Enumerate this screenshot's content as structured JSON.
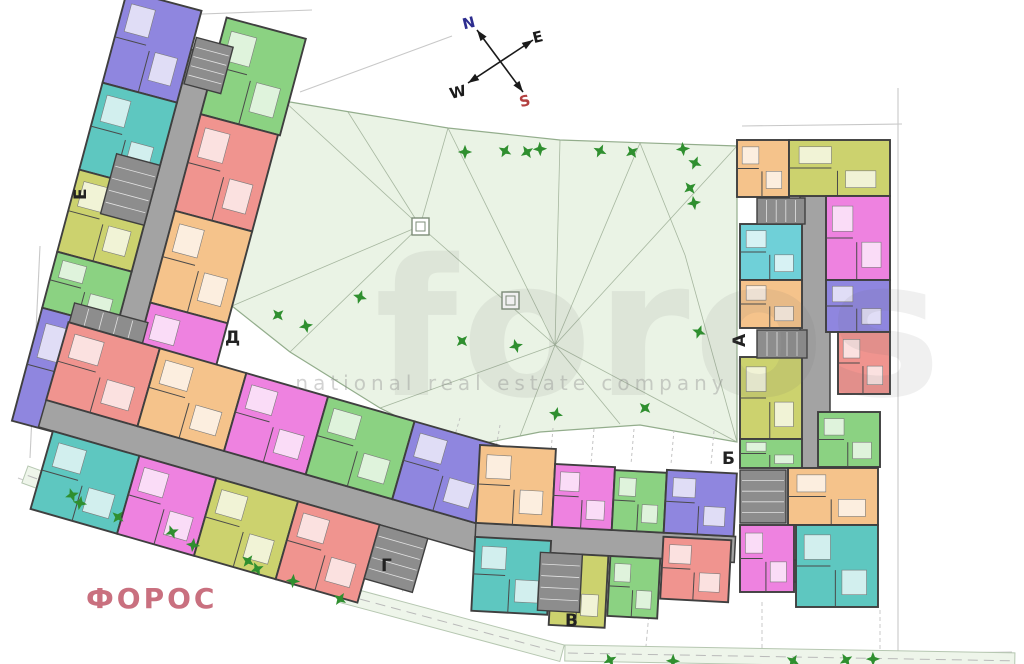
{
  "logo": {
    "text": "ФОРОС"
  },
  "watermark": {
    "line1": "foros",
    "line2": "national real estate company"
  },
  "compass": {
    "axes": [
      {
        "x1": 477,
        "y1": 30,
        "x2": 523,
        "y2": 92
      },
      {
        "x1": 468,
        "y1": 83,
        "x2": 533,
        "y2": 40
      }
    ],
    "letters": [
      {
        "t": "N",
        "x": 470,
        "y": 28,
        "c": "#2d2d8f"
      },
      {
        "t": "E",
        "x": 539,
        "y": 42,
        "c": "#1a1a1a"
      },
      {
        "t": "W",
        "x": 459,
        "y": 97,
        "c": "#1a1a1a"
      },
      {
        "t": "S",
        "x": 526,
        "y": 106,
        "c": "#b34040"
      }
    ]
  },
  "section_labels": [
    {
      "t": "Е",
      "x": 86,
      "y": 200,
      "r": -90
    },
    {
      "t": "Д",
      "x": 225,
      "y": 343,
      "r": 0
    },
    {
      "t": "Г",
      "x": 381,
      "y": 571,
      "r": 0
    },
    {
      "t": "В",
      "x": 565,
      "y": 626,
      "r": 0
    },
    {
      "t": "Б",
      "x": 722,
      "y": 464,
      "r": 0
    },
    {
      "t": "А",
      "x": 745,
      "y": 347,
      "r": -90
    }
  ],
  "palette": {
    "green": "#8bd282",
    "purple": "#8f86df",
    "teal": "#5ec7c0",
    "red": "#f0948f",
    "orange": "#f5c38b",
    "magenta": "#ee82e0",
    "olive": "#ccd26e",
    "cyan": "#6fd0d8",
    "corridor": "#a3a3a3",
    "stair": "#8d8d8d",
    "wall": "#3f3f3f",
    "tree": "#2f8f2f",
    "court_fill": "#eaf3e5",
    "court_stroke": "#93ad8c",
    "mesh": "#9aab93",
    "dim": "#c8c8c8",
    "strip_fill": "#eef5ea",
    "strip_stroke": "#b6c7b1"
  },
  "plan": {
    "courtyard": {
      "points": "284,101 350,112 448,128 560,140 737,146 737,442 640,425 540,432 460,448 380,408 290,352 232,306",
      "mesh": [
        [
          284,
          101,
          420,
          226
        ],
        [
          448,
          128,
          420,
          226
        ],
        [
          420,
          226,
          232,
          306
        ],
        [
          420,
          226,
          348,
          112
        ],
        [
          420,
          226,
          555,
          345
        ],
        [
          420,
          226,
          290,
          352
        ],
        [
          448,
          128,
          555,
          345
        ],
        [
          560,
          140,
          555,
          345
        ],
        [
          640,
          143,
          555,
          345
        ],
        [
          737,
          146,
          555,
          345
        ],
        [
          737,
          442,
          555,
          345
        ],
        [
          620,
          424,
          555,
          345
        ],
        [
          520,
          436,
          555,
          345
        ],
        [
          380,
          408,
          555,
          345
        ],
        [
          640,
          143,
          685,
          255
        ],
        [
          685,
          255,
          737,
          442
        ]
      ],
      "hatches": [
        [
          412,
          218,
          17,
          17
        ],
        [
          502,
          292,
          17,
          17
        ]
      ]
    },
    "gridlines": [
      [
        553,
        428,
        550,
        463
      ],
      [
        594,
        429,
        591,
        464
      ],
      [
        634,
        429,
        631,
        464
      ],
      [
        674,
        430,
        671,
        464
      ],
      [
        714,
        431,
        711,
        465
      ],
      [
        500,
        425,
        494,
        460
      ],
      [
        460,
        418,
        450,
        452
      ]
    ],
    "dims": [
      "148,16 312,10",
      "40,246 30,458",
      "18,478 340,598 620,658",
      "620,658 1012,652",
      "898,88 898,652",
      "742,126 902,124",
      "300,92 452,36"
    ],
    "connectors": [
      [
        95,
        437,
        58,
        480
      ],
      [
        205,
        478,
        178,
        520
      ],
      [
        312,
        514,
        290,
        556
      ],
      [
        422,
        550,
        402,
        592
      ],
      [
        532,
        568,
        524,
        606
      ],
      [
        650,
        602,
        646,
        646
      ],
      [
        762,
        602,
        762,
        650
      ],
      [
        880,
        610,
        880,
        652
      ]
    ],
    "strips": [
      {
        "tx": 28,
        "ty": 466,
        "rot": 20,
        "w": 342,
        "h": 18
      },
      {
        "tx": 344,
        "ty": 586,
        "rot": 15,
        "w": 228,
        "h": 17
      },
      {
        "tx": 565,
        "ty": 645,
        "rot": 1,
        "w": 450,
        "h": 16
      }
    ],
    "wings": [
      {
        "name": "wing-e-d",
        "pivot": [
          215,
          30
        ],
        "rot": 15,
        "corridors": [
          [
            197,
            55,
            26,
            400
          ]
        ],
        "stairs": [
          [
            199,
            42,
            38,
            48
          ],
          [
            152,
            175,
            45,
            62
          ],
          [
            150,
            330,
            76,
            68
          ]
        ],
        "units": [
          [
            223,
            15,
            82,
            100,
            "green"
          ],
          [
            120,
            15,
            77,
            95,
            "purple"
          ],
          [
            223,
            115,
            80,
            100,
            "red"
          ],
          [
            120,
            110,
            77,
            90,
            "teal"
          ],
          [
            223,
            215,
            80,
            95,
            "orange"
          ],
          [
            120,
            200,
            77,
            85,
            "olive"
          ],
          [
            223,
            310,
            80,
            85,
            "magenta"
          ],
          [
            120,
            285,
            77,
            58,
            "green"
          ],
          [
            120,
            343,
            78,
            117,
            "purple"
          ],
          [
            223,
            395,
            80,
            72,
            "teal"
          ]
        ]
      },
      {
        "name": "wing-g",
        "tx": 100,
        "ty": 430,
        "rot": 16,
        "corridors": [
          [
            -60,
            -14,
            465,
            28
          ]
        ],
        "stairs": [
          [
            295,
            14,
            50,
            56
          ]
        ],
        "units": [
          [
            -60,
            -95,
            95,
            81,
            "red"
          ],
          [
            35,
            -95,
            90,
            81,
            "orange"
          ],
          [
            125,
            -95,
            85,
            81,
            "magenta"
          ],
          [
            210,
            -95,
            90,
            81,
            "green"
          ],
          [
            300,
            -95,
            88,
            81,
            "purple"
          ],
          [
            -45,
            14,
            90,
            81,
            "teal"
          ],
          [
            45,
            14,
            80,
            81,
            "magenta"
          ],
          [
            125,
            14,
            85,
            81,
            "olive"
          ],
          [
            210,
            14,
            85,
            81,
            "red"
          ]
        ]
      },
      {
        "name": "wing-v",
        "tx": 480,
        "ty": 445,
        "rot": 3,
        "corridors": [
          [
            0,
            78,
            260,
            26
          ]
        ],
        "stairs": [
          [
            66,
            104,
            42,
            58
          ]
        ],
        "units": [
          [
            0,
            0,
            76,
            78,
            "orange"
          ],
          [
            76,
            15,
            60,
            63,
            "magenta"
          ],
          [
            136,
            18,
            52,
            60,
            "green"
          ],
          [
            188,
            15,
            70,
            63,
            "purple"
          ],
          [
            0,
            92,
            76,
            74,
            "teal"
          ],
          [
            78,
            104,
            56,
            72,
            "olive"
          ],
          [
            136,
            104,
            50,
            60,
            "green"
          ],
          [
            188,
            82,
            68,
            62,
            "red"
          ]
        ]
      },
      {
        "name": "wing-a-b",
        "tx": 0,
        "ty": 0,
        "rot": 0,
        "corridors": [
          [
            800,
            196,
            30,
            404
          ],
          [
            745,
            560,
            60,
            22
          ]
        ],
        "stairs": [
          [
            757,
            198,
            48,
            26
          ],
          [
            757,
            330,
            50,
            28
          ],
          [
            740,
            470,
            46,
            53
          ]
        ],
        "units": [
          [
            737,
            140,
            52,
            57,
            "orange"
          ],
          [
            789,
            140,
            101,
            56,
            "olive"
          ],
          [
            826,
            196,
            64,
            84,
            "magenta"
          ],
          [
            740,
            224,
            62,
            56,
            "cyan"
          ],
          [
            740,
            280,
            62,
            48,
            "orange"
          ],
          [
            826,
            280,
            64,
            52,
            "purple"
          ],
          [
            838,
            332,
            52,
            62,
            "red"
          ],
          [
            740,
            357,
            62,
            82,
            "olive"
          ],
          [
            818,
            412,
            62,
            55,
            "green"
          ],
          [
            740,
            439,
            62,
            29,
            "green"
          ],
          [
            788,
            468,
            90,
            57,
            "orange"
          ],
          [
            740,
            525,
            54,
            67,
            "magenta"
          ],
          [
            796,
            525,
            82,
            82,
            "teal"
          ]
        ]
      }
    ],
    "trees": [
      [
        465,
        152
      ],
      [
        505,
        151
      ],
      [
        527,
        152
      ],
      [
        540,
        149
      ],
      [
        600,
        151
      ],
      [
        632,
        152
      ],
      [
        683,
        149
      ],
      [
        695,
        163
      ],
      [
        690,
        188
      ],
      [
        694,
        203
      ],
      [
        699,
        332
      ],
      [
        278,
        315
      ],
      [
        306,
        326
      ],
      [
        360,
        297
      ],
      [
        462,
        341
      ],
      [
        516,
        346
      ],
      [
        556,
        414
      ],
      [
        645,
        408
      ],
      [
        72,
        495
      ],
      [
        80,
        503
      ],
      [
        118,
        517
      ],
      [
        172,
        532
      ],
      [
        193,
        545
      ],
      [
        248,
        561
      ],
      [
        257,
        569
      ],
      [
        293,
        581
      ],
      [
        340,
        599
      ],
      [
        610,
        660
      ],
      [
        673,
        661
      ],
      [
        793,
        661
      ],
      [
        846,
        660
      ],
      [
        873,
        659
      ]
    ]
  }
}
